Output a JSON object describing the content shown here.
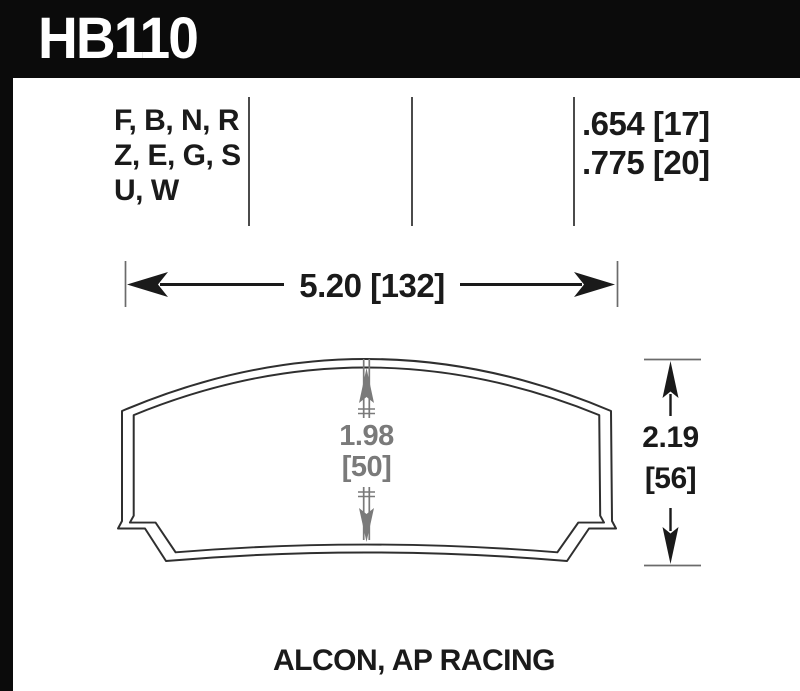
{
  "part": {
    "number": "HB110"
  },
  "compound_table": {
    "compounds": [
      "F, B, N, R",
      "Z, E, G, S",
      "U, W"
    ],
    "thicknesses": [
      ".654 [17]",
      ".775 [20]"
    ]
  },
  "dimensions": {
    "width_label": "5.20 [132]",
    "inner_height_in": "1.98",
    "inner_height_mm": "[50]",
    "overall_height_in": "2.19",
    "overall_height_mm": "[56]"
  },
  "footer": {
    "caliper_applications": "ALCON, AP RACING"
  },
  "colors": {
    "header_bg": "#0b0b0b",
    "outline": "#2f2f2f",
    "dim_gray": "#7a7a7a",
    "tick_gray": "#6b6b6b",
    "text": "#1a1a1a"
  }
}
